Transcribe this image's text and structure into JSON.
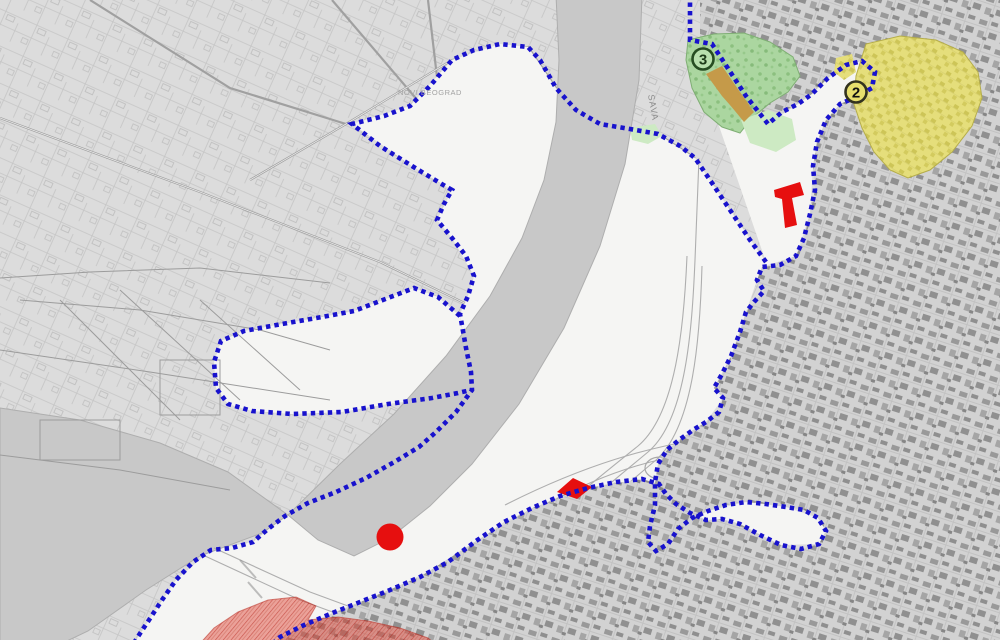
{
  "map": {
    "labels": {
      "river": "SAVA",
      "district": "NOVI BEOGRAD"
    },
    "markers": [
      {
        "number": "3",
        "zone": "green"
      },
      {
        "number": "2",
        "zone": "yellow"
      }
    ],
    "colors": {
      "boundary_blue": "#1812cd",
      "zone_green": "#abd6a0",
      "zone_green_light": "#cdeac3",
      "zone_yellow": "#e5de7b",
      "tan_patch": "#c59a49",
      "marker_red": "#e60f0f",
      "river": "#c8c8c8",
      "background": "#dcdcdc",
      "interior_white": "#f5f5f3",
      "marker3_ring": "#274d22",
      "marker2_ring": "#33331f"
    }
  }
}
